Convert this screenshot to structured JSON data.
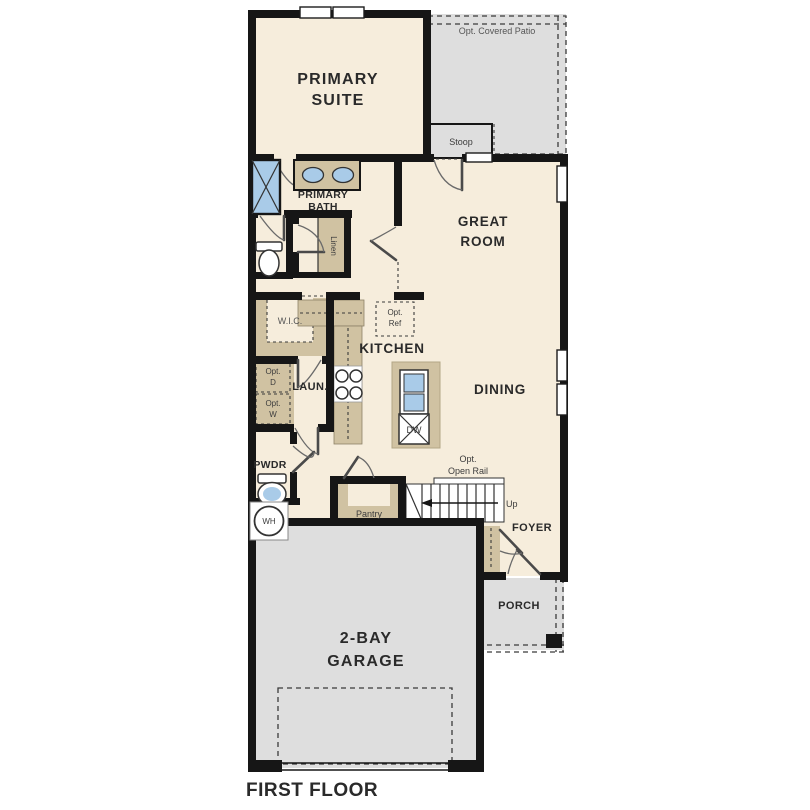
{
  "title": "FIRST FLOOR",
  "colors": {
    "wall": "#161616",
    "floor": "#f6eddc",
    "outdoor": "#dedede",
    "cabinet": "#d0c2a2",
    "fixture": "#a9cbe8"
  },
  "rooms": {
    "primary_suite": {
      "lines": [
        "PRIMARY",
        "SUITE"
      ]
    },
    "opt_covered_patio": {
      "label": "Opt. Covered Patio"
    },
    "stoop": {
      "label": "Stoop"
    },
    "primary_bath": {
      "lines": [
        "PRIMARY",
        "BATH"
      ]
    },
    "great_room": {
      "lines": [
        "GREAT",
        "ROOM"
      ]
    },
    "linen": {
      "label": "Linen"
    },
    "wic": {
      "label": "W.I.C."
    },
    "kitchen": {
      "label": "KITCHEN"
    },
    "dining": {
      "label": "DINING"
    },
    "laundry": {
      "label": "LAUN."
    },
    "pwdr": {
      "label": "PWDR"
    },
    "pantry": {
      "label": "Pantry"
    },
    "foyer": {
      "label": "FOYER"
    },
    "porch": {
      "label": "PORCH"
    },
    "garage": {
      "lines": [
        "2-BAY",
        "GARAGE"
      ]
    }
  },
  "annotations": {
    "opt_ref": {
      "lines": [
        "Opt.",
        "Ref"
      ]
    },
    "opt_d": {
      "lines": [
        "Opt.",
        "D"
      ]
    },
    "opt_w": {
      "lines": [
        "Opt.",
        "W"
      ]
    },
    "opt_open_rail": {
      "lines": [
        "Opt.",
        "Open Rail"
      ]
    },
    "wh": "WH",
    "dw": "DW",
    "up": "Up"
  }
}
